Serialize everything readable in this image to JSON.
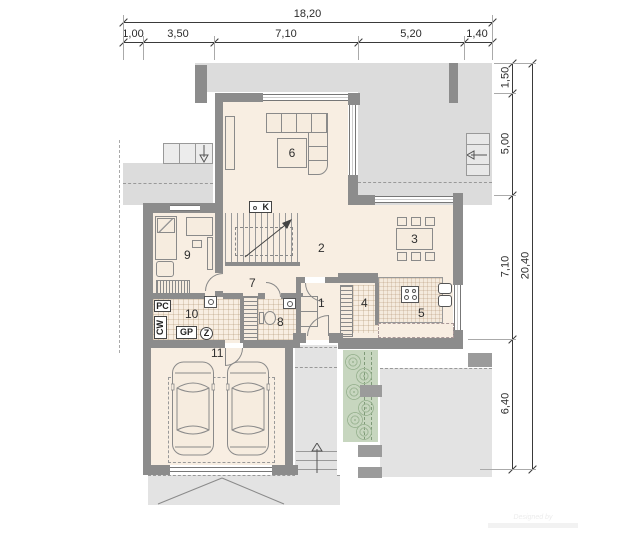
{
  "plan": {
    "dim_top": {
      "total": "18,20",
      "segs": [
        "1,00",
        "3,50",
        "7,10",
        "5,20",
        "1,40"
      ]
    },
    "dim_right": {
      "total": "20,40",
      "segs": [
        "1,50",
        "5,00",
        "7,10",
        "6,40"
      ]
    },
    "rooms": {
      "numbers": [
        "1",
        "2",
        "3",
        "4",
        "5",
        "6",
        "7",
        "8",
        "9",
        "10",
        "11"
      ]
    },
    "equipment": {
      "pc": "PC",
      "cw": "CW",
      "gp": "GP",
      "z": "Z",
      "fireplace": "K"
    },
    "watermark": {
      "line1": "Designed by"
    }
  },
  "colors": {
    "wall": "#8c8c8c",
    "floor": "#f8eee2",
    "exterior": "#dcdcdc",
    "green": "#c7d6bf"
  }
}
